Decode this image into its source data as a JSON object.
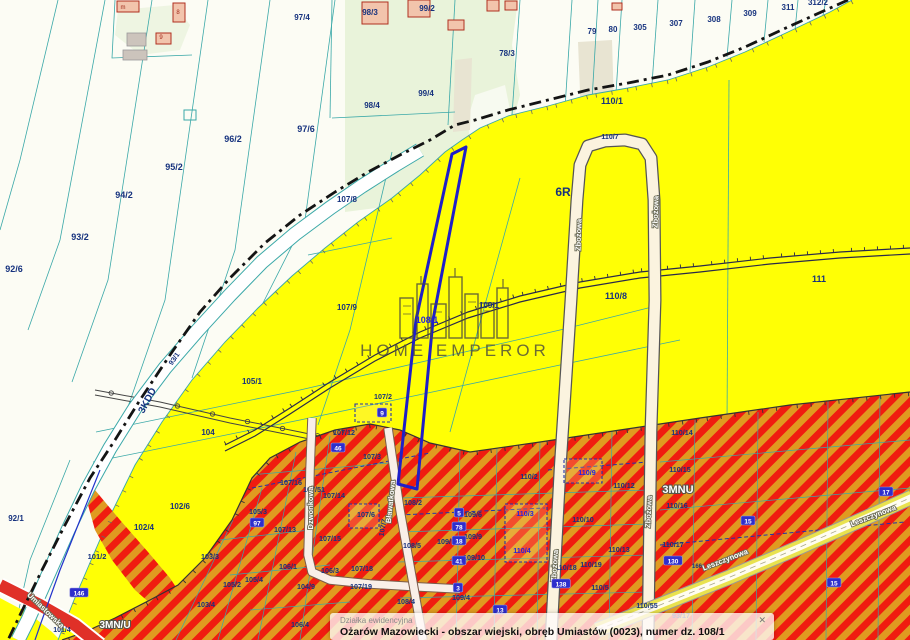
{
  "popup": {
    "title": "Działka ewidencyjna",
    "line": "Ożarów Mazowiecki - obszar wiejski, obręb Umiastów (0023), numer dz. 108/1",
    "close": "✕"
  },
  "watermark": {
    "text": "HOME EMPEROR"
  },
  "colors": {
    "navy_label": "#16327e",
    "blue_label": "#2424dd",
    "teal": "#3aa8a8",
    "yellow": "#ffff05",
    "stripe_red": "#f01c10",
    "stripe_orange": "#e09a20",
    "selected_parcel": "#1f1fc8",
    "watermark": "#4c4c3e"
  },
  "parcel_labels": [
    {
      "t": "92/6",
      "x": 14,
      "y": 272,
      "s": 9
    },
    {
      "t": "93/2",
      "x": 80,
      "y": 240,
      "s": 9
    },
    {
      "t": "94/2",
      "x": 124,
      "y": 198,
      "s": 9
    },
    {
      "t": "95/2",
      "x": 174,
      "y": 170,
      "s": 9
    },
    {
      "t": "96/2",
      "x": 233,
      "y": 142,
      "s": 9
    },
    {
      "t": "97/6",
      "x": 306,
      "y": 132,
      "s": 9
    },
    {
      "t": "97/4",
      "x": 302,
      "y": 20,
      "s": 8
    },
    {
      "t": "98/3",
      "x": 370,
      "y": 15,
      "s": 8
    },
    {
      "t": "99/2",
      "x": 427,
      "y": 11,
      "s": 8
    },
    {
      "t": "98/4",
      "x": 372,
      "y": 108,
      "s": 8
    },
    {
      "t": "99/4",
      "x": 426,
      "y": 96,
      "s": 8
    },
    {
      "t": "78/3",
      "x": 507,
      "y": 56,
      "s": 8
    },
    {
      "t": "79",
      "x": 592,
      "y": 34,
      "s": 8
    },
    {
      "t": "80",
      "x": 613,
      "y": 32,
      "s": 8
    },
    {
      "t": "305",
      "x": 640,
      "y": 30,
      "s": 8
    },
    {
      "t": "307",
      "x": 676,
      "y": 26,
      "s": 8
    },
    {
      "t": "308",
      "x": 714,
      "y": 22,
      "s": 8
    },
    {
      "t": "309",
      "x": 750,
      "y": 16,
      "s": 8
    },
    {
      "t": "311",
      "x": 788,
      "y": 10,
      "s": 8
    },
    {
      "t": "312/2",
      "x": 818,
      "y": 5,
      "s": 8
    },
    {
      "t": "92/1",
      "x": 16,
      "y": 521,
      "s": 8
    },
    {
      "t": "93/1",
      "x": 176,
      "y": 360,
      "s": 7,
      "r": -55
    },
    {
      "t": "3KDD",
      "x": 150,
      "y": 402,
      "s": 10,
      "r": -62
    },
    {
      "t": "110/1",
      "x": 612,
      "y": 104,
      "s": 9
    },
    {
      "t": "110/7",
      "x": 610,
      "y": 139,
      "s": 7
    },
    {
      "t": "6R",
      "x": 563,
      "y": 196,
      "s": 12
    },
    {
      "t": "110/8",
      "x": 616,
      "y": 299,
      "s": 9
    },
    {
      "t": "111",
      "x": 819,
      "y": 282,
      "s": 9
    },
    {
      "t": "107/8",
      "x": 347,
      "y": 202,
      "s": 8
    },
    {
      "t": "107/9",
      "x": 347,
      "y": 310,
      "s": 8
    },
    {
      "t": "109/1",
      "x": 489,
      "y": 308,
      "s": 8
    },
    {
      "t": "108/1",
      "x": 427,
      "y": 323,
      "s": 9,
      "c": "blue"
    },
    {
      "t": "105/1",
      "x": 252,
      "y": 384,
      "s": 8
    },
    {
      "t": "104",
      "x": 208,
      "y": 435,
      "s": 8
    },
    {
      "t": "102/6",
      "x": 180,
      "y": 509,
      "s": 8
    },
    {
      "t": "102/4",
      "x": 144,
      "y": 530,
      "s": 8
    },
    {
      "t": "101/2",
      "x": 97,
      "y": 559,
      "s": 7.5
    },
    {
      "t": "101/4",
      "x": 62,
      "y": 632,
      "s": 7
    },
    {
      "t": "103/3",
      "x": 210,
      "y": 559,
      "s": 7.2
    },
    {
      "t": "103/4",
      "x": 206,
      "y": 607,
      "s": 7.2
    },
    {
      "t": "105/2",
      "x": 232,
      "y": 587,
      "s": 7.2
    },
    {
      "t": "105/4",
      "x": 254,
      "y": 582,
      "s": 7.2
    },
    {
      "t": "105/3",
      "x": 258,
      "y": 514,
      "s": 7.2
    },
    {
      "t": "106/1",
      "x": 288,
      "y": 569,
      "s": 7.2
    },
    {
      "t": "107/13",
      "x": 285,
      "y": 532,
      "s": 7.2
    },
    {
      "t": "104/9",
      "x": 306,
      "y": 589,
      "s": 7.2
    },
    {
      "t": "106/3",
      "x": 330,
      "y": 573,
      "s": 7.2
    },
    {
      "t": "106/4",
      "x": 300,
      "y": 627,
      "s": 7.2
    },
    {
      "t": "107/18",
      "x": 362,
      "y": 571,
      "s": 7.2
    },
    {
      "t": "107/19",
      "x": 361,
      "y": 589,
      "s": 7.2
    },
    {
      "t": "107/15",
      "x": 330,
      "y": 541,
      "s": 7.2
    },
    {
      "t": "107/14",
      "x": 334,
      "y": 498,
      "s": 7.2
    },
    {
      "t": "107/16",
      "x": 291,
      "y": 485,
      "s": 7.2
    },
    {
      "t": "107/51",
      "x": 314,
      "y": 492,
      "s": 7.2
    },
    {
      "t": "107/6",
      "x": 366,
      "y": 517,
      "s": 7.2
    },
    {
      "t": "107/12",
      "x": 344,
      "y": 435,
      "s": 7.2
    },
    {
      "t": "107/2",
      "x": 383,
      "y": 399,
      "s": 7.2
    },
    {
      "t": "107/3",
      "x": 372,
      "y": 459,
      "s": 7.2
    },
    {
      "t": "107/7",
      "x": 385,
      "y": 528,
      "s": 7,
      "r": -80
    },
    {
      "t": "108/2",
      "x": 413,
      "y": 505,
      "s": 7.2
    },
    {
      "t": "108/5",
      "x": 412,
      "y": 548,
      "s": 7.2
    },
    {
      "t": "108/4",
      "x": 406,
      "y": 604,
      "s": 7.2
    },
    {
      "t": "109/6",
      "x": 473,
      "y": 517,
      "s": 7.2
    },
    {
      "t": "109/9",
      "x": 473,
      "y": 539,
      "s": 7.2
    },
    {
      "t": "109/10",
      "x": 474,
      "y": 560,
      "s": 7.2
    },
    {
      "t": "109/5",
      "x": 446,
      "y": 544,
      "s": 7.2
    },
    {
      "t": "109/4",
      "x": 461,
      "y": 600,
      "s": 7.2
    },
    {
      "t": "110/2",
      "x": 529,
      "y": 479,
      "s": 7.2
    },
    {
      "t": "110/9",
      "x": 587,
      "y": 475,
      "s": 7.2,
      "c": "blue"
    },
    {
      "t": "110/3",
      "x": 525,
      "y": 516,
      "s": 7.2,
      "c": "blue"
    },
    {
      "t": "110/4",
      "x": 522,
      "y": 553,
      "s": 7.2,
      "c": "blue"
    },
    {
      "t": "110/10",
      "x": 583,
      "y": 522,
      "s": 7.2
    },
    {
      "t": "110/18",
      "x": 566,
      "y": 570,
      "s": 7.2
    },
    {
      "t": "110/19",
      "x": 591,
      "y": 567,
      "s": 7.2
    },
    {
      "t": "110/13",
      "x": 619,
      "y": 552,
      "s": 7.2
    },
    {
      "t": "110/5",
      "x": 600,
      "y": 590,
      "s": 7.2
    },
    {
      "t": "110/55",
      "x": 647,
      "y": 608,
      "s": 7.2
    },
    {
      "t": "110/12",
      "x": 624,
      "y": 488,
      "s": 7.2
    },
    {
      "t": "110/14",
      "x": 682,
      "y": 435,
      "s": 7.2
    },
    {
      "t": "110/15",
      "x": 680,
      "y": 472,
      "s": 7.2
    },
    {
      "t": "110/16",
      "x": 677,
      "y": 508,
      "s": 7.2
    },
    {
      "t": "110/17",
      "x": 673,
      "y": 547,
      "s": 7.2
    },
    {
      "t": "93/17",
      "x": 681,
      "y": 618,
      "s": 7.2
    },
    {
      "t": "166",
      "x": 697,
      "y": 568,
      "s": 6
    }
  ],
  "zone_labels": [
    {
      "t": "3MN/U",
      "x": 115,
      "y": 628,
      "s": 10
    },
    {
      "t": "3MNU",
      "x": 678,
      "y": 493,
      "s": 11
    }
  ],
  "street_labels": [
    {
      "t": "Umiastowska",
      "x": 44,
      "y": 612,
      "r": 44
    },
    {
      "t": "Dzwonkowa",
      "x": 313,
      "y": 508,
      "r": -90
    },
    {
      "t": "Bławatkowa",
      "x": 393,
      "y": 502,
      "r": -84
    },
    {
      "t": "Zbożowa",
      "x": 581,
      "y": 235,
      "r": -88
    },
    {
      "t": "Zbożowa",
      "x": 658,
      "y": 212,
      "r": -88
    },
    {
      "t": "Zbożowa",
      "x": 557,
      "y": 566,
      "r": -86
    },
    {
      "t": "Zbożowa",
      "x": 651,
      "y": 512,
      "r": -87
    },
    {
      "t": "Leszczynowa",
      "x": 726,
      "y": 562,
      "r": -21
    },
    {
      "t": "Leszczynowa",
      "x": 874,
      "y": 518,
      "r": -21
    }
  ],
  "building_glyphs": [
    {
      "t": "m",
      "x": 123,
      "y": 9
    },
    {
      "t": "8",
      "x": 178,
      "y": 14
    },
    {
      "t": "9",
      "x": 161,
      "y": 39
    }
  ],
  "markers": [
    {
      "t": "146",
      "x": 79,
      "y": 593
    },
    {
      "t": "97",
      "x": 257,
      "y": 523
    },
    {
      "t": "46",
      "x": 338,
      "y": 448
    },
    {
      "t": "9",
      "x": 382,
      "y": 413
    },
    {
      "t": "5",
      "x": 459,
      "y": 513
    },
    {
      "t": "78",
      "x": 459,
      "y": 527
    },
    {
      "t": "18",
      "x": 459,
      "y": 541
    },
    {
      "t": "41",
      "x": 459,
      "y": 561
    },
    {
      "t": "3",
      "x": 458,
      "y": 588
    },
    {
      "t": "13",
      "x": 500,
      "y": 610
    },
    {
      "t": "138",
      "x": 561,
      "y": 584
    },
    {
      "t": "130",
      "x": 673,
      "y": 561
    },
    {
      "t": "15",
      "x": 748,
      "y": 521
    },
    {
      "t": "17",
      "x": 886,
      "y": 492
    },
    {
      "t": "15",
      "x": 834,
      "y": 583
    }
  ]
}
